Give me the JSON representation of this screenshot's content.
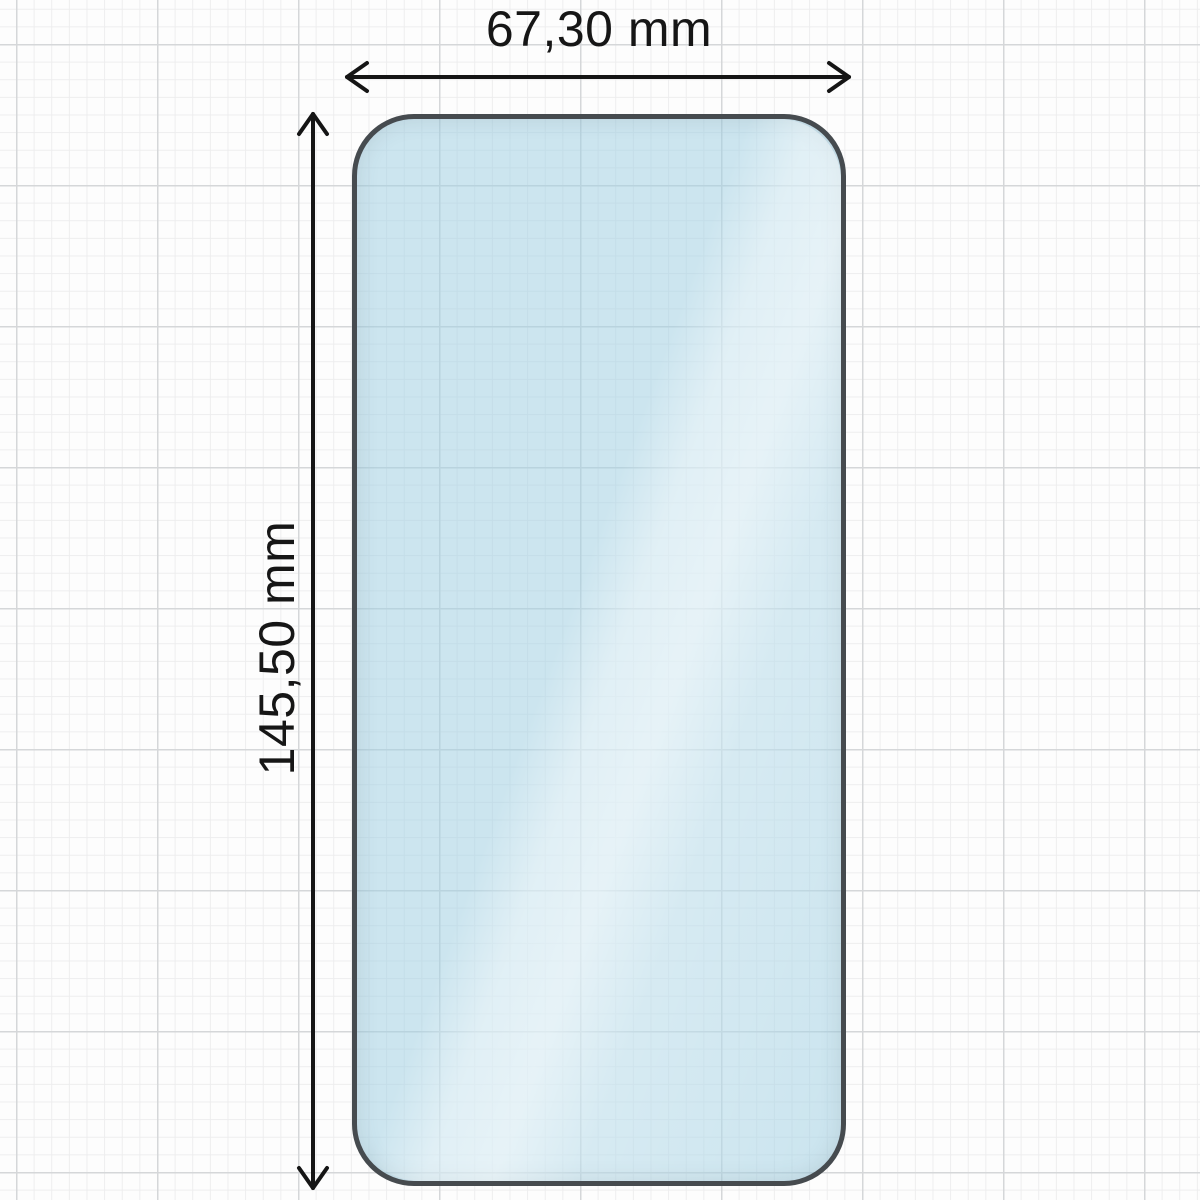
{
  "diagram": {
    "type": "dimension-drawing",
    "subject": "phone-screen-protector-glass",
    "width_label": "67,30 mm",
    "height_label": "145,50 mm",
    "colors": {
      "background": "#fdfdfd",
      "grid_minor": "#ededee",
      "grid_major": "#d5d7d9",
      "glass_fill": "#d0e7f0",
      "glass_border": "#464b4f",
      "glare": "#e7f4f9",
      "dimension_lines": "#151515",
      "label_text": "#161616"
    }
  }
}
